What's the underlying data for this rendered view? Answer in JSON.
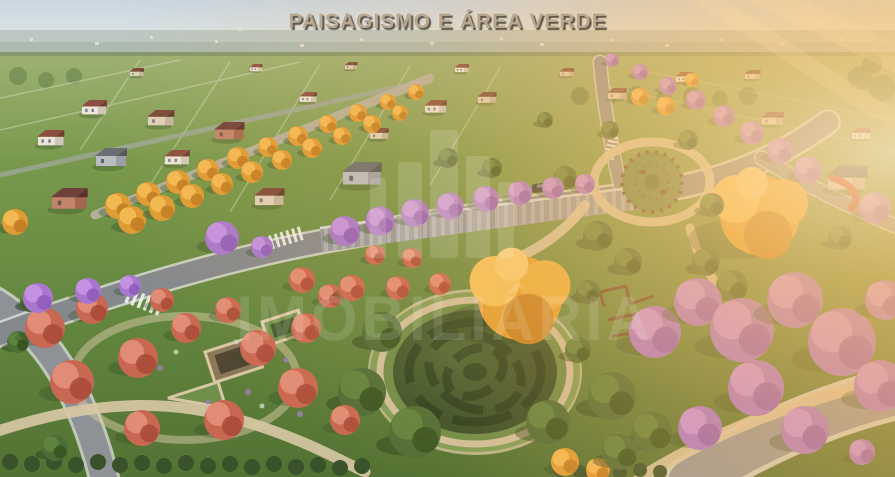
{
  "title": {
    "text": "PAISAGISMO E ÁREA VERDE"
  },
  "watermark": {
    "text": "IMOBILIÁRIA",
    "logo": "towers-monogram"
  },
  "scene": {
    "type": "aerial-3d-render",
    "subject": "master-planned residential community: tree-lined streets, central park with circular pergola garden, playground, hedge maze and flower gardens under warm side sunlight",
    "palette": {
      "sky": "#cdd9e3",
      "horizon_haze": "#b6c2bd",
      "grass": "#6f9247",
      "grass_light": "#8fae62",
      "road_gray": "#85898d",
      "curb_white": "#d9dad6",
      "path_beige": "#d9c9a6",
      "jacaranda_purple": "#a877cf",
      "ipe_yellow_orange": "#df9c33",
      "flowering_red": "#c96852",
      "tree_green": "#4d6d36",
      "maze_hedge": "#4b6836",
      "maze_shadow": "#324d26",
      "sun_flare": "#ffc069",
      "title_tan": "#b9a78f",
      "roof_red": "#8c4f3f",
      "wall_gray": "#9ea4a9",
      "slide_red": "#c23b2e"
    }
  }
}
